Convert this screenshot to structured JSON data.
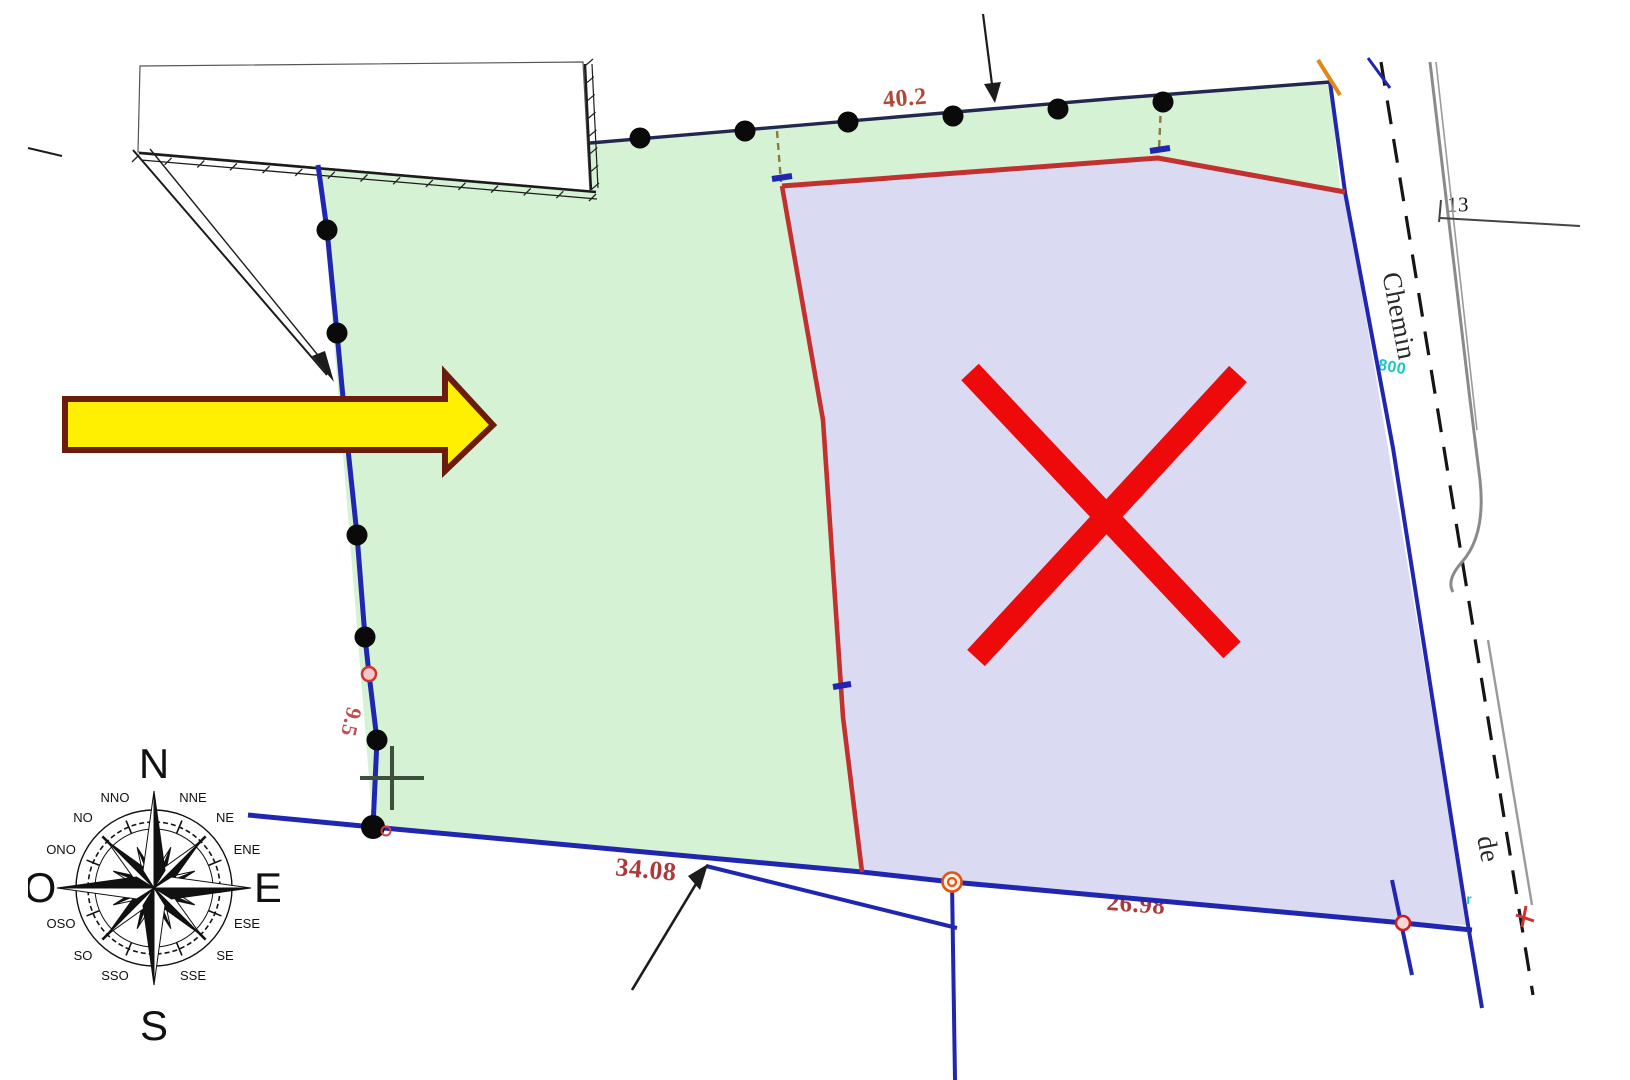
{
  "lots": {
    "lot1": {
      "name": "Lot 1",
      "area": "S = 1347 m²"
    },
    "lot2": {
      "name": "Lot 2",
      "area_prefix": "S =",
      "area_suffix": "96 m²"
    }
  },
  "measurements": {
    "top": "40.2",
    "building": "15.7",
    "wall_side": "3.1",
    "offset_left": "4.5",
    "lot2_north_a": "20.7",
    "lot2_north_b": "7.4",
    "offset_right": "4.0",
    "east_strip": "6.0",
    "divider": "41.8",
    "west": "9.5",
    "south_a": "28.4",
    "south_total": "34.08",
    "south_b": "5.7",
    "south_c": "26.98",
    "parcel_number": "13"
  },
  "markers": {
    "oge": "OGE",
    "bex_west": "Bex",
    "bex_east": "Bex"
  },
  "road": {
    "name_part1": "Chemin",
    "name_part2": "de"
  },
  "annotations": {
    "cyan_point_a": "800",
    "cyan_point_b": "xar"
  },
  "compass": {
    "n": "N",
    "s": "S",
    "e": "E",
    "o": "O",
    "nne": "NNE",
    "ne": "NE",
    "ene": "ENE",
    "ese": "ESE",
    "se": "SE",
    "sse": "SSE",
    "sso": "SSO",
    "so": "SO",
    "oso": "OSO",
    "ono": "ONO",
    "no": "NO",
    "nno": "NNO"
  },
  "colors": {
    "lot1_fill": "#d6f2d4",
    "lot2_fill": "#dadaf2",
    "boundary_blue": "#2026b0",
    "divider_red": "#c23030",
    "highlight_arrow_fill": "#ffef00",
    "highlight_arrow_border": "#6b1c0c",
    "cross_out_red": "#ee0a0a"
  }
}
